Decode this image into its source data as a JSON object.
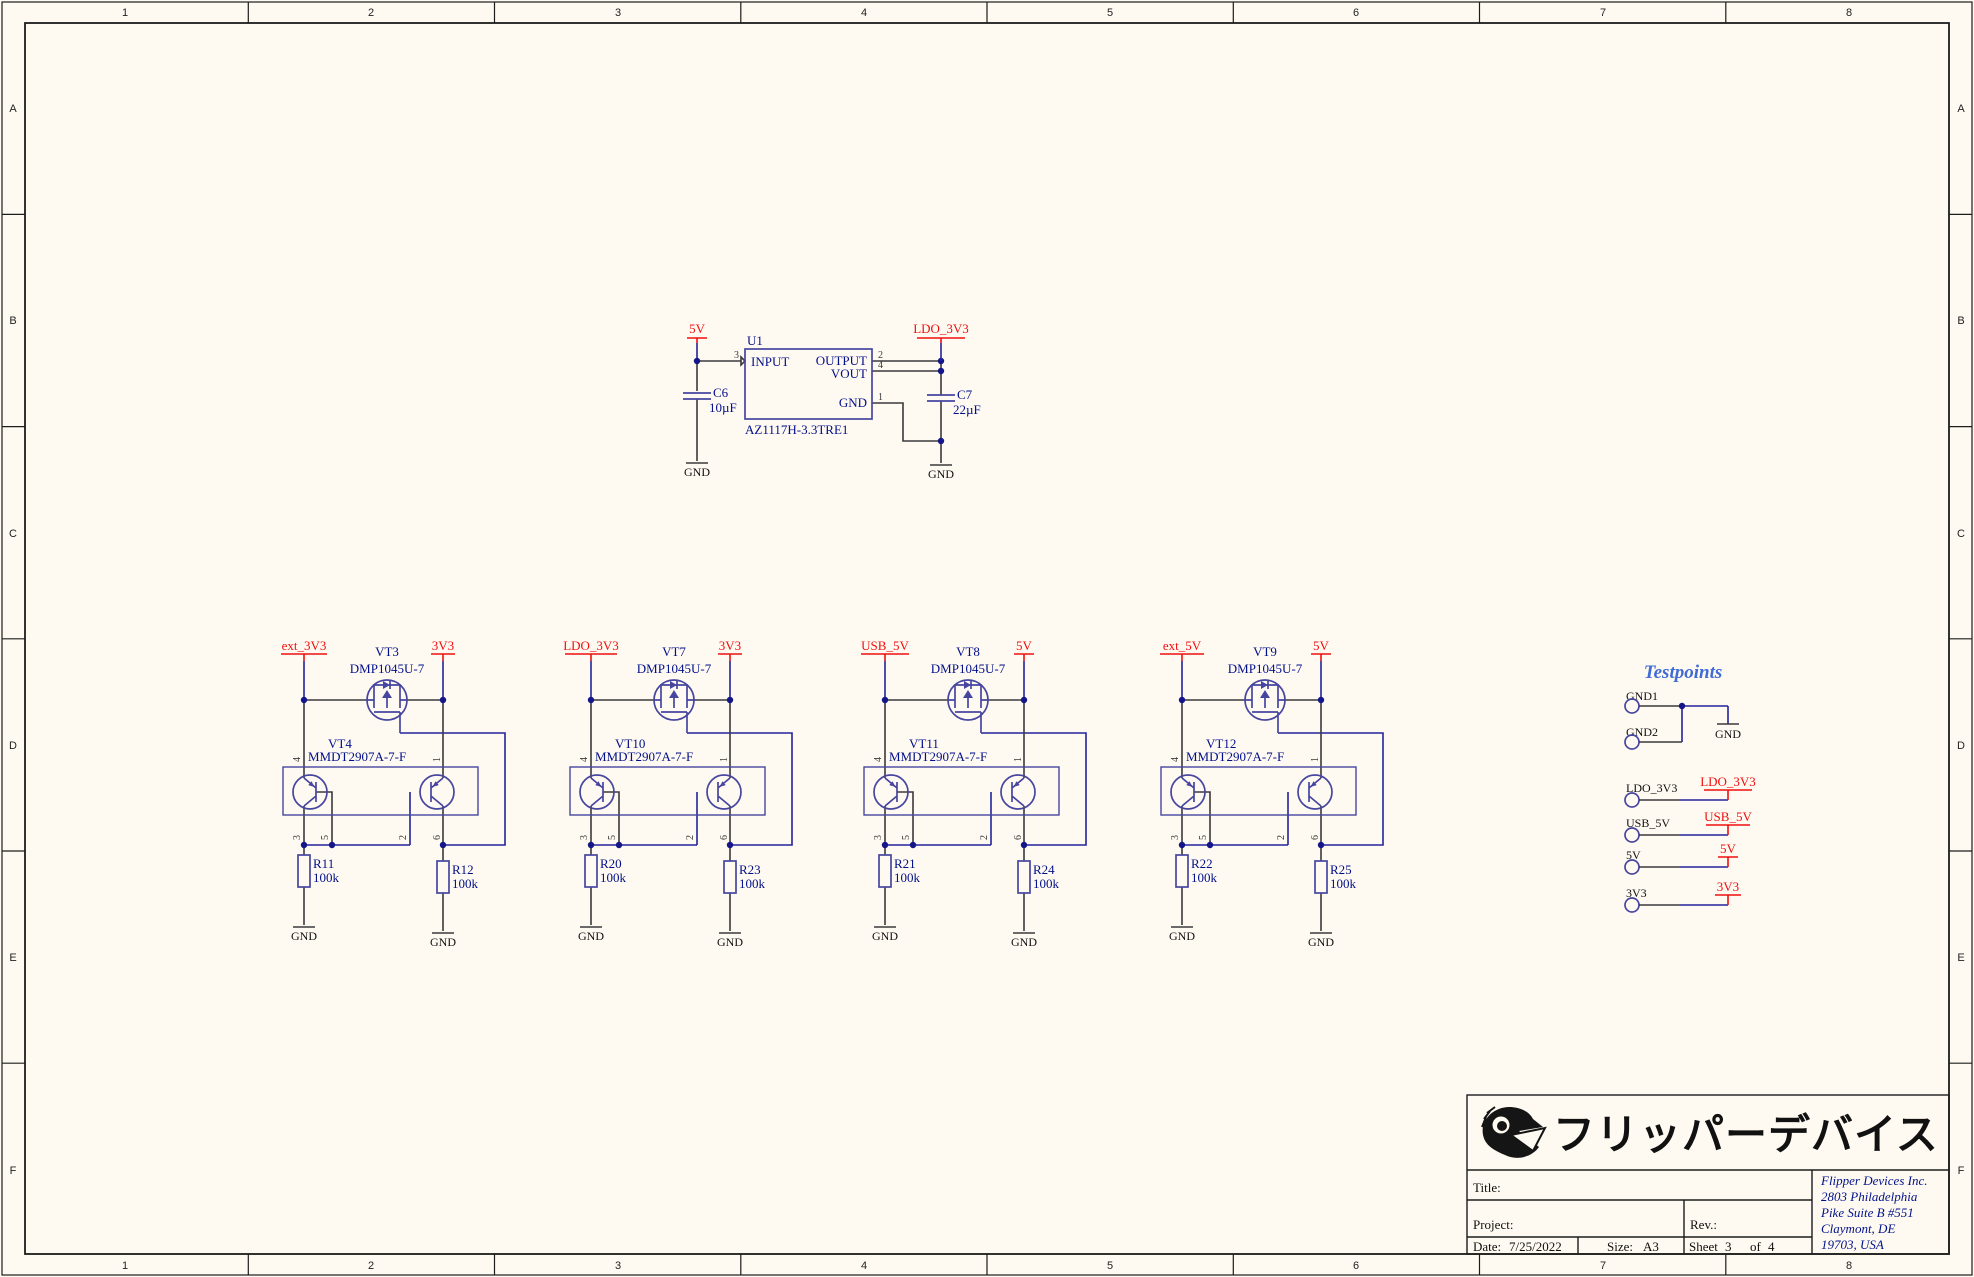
{
  "sheet": {
    "border": {
      "columns": [
        "1",
        "2",
        "3",
        "4",
        "5",
        "6",
        "7",
        "8"
      ],
      "rows": [
        "A",
        "B",
        "C",
        "D",
        "E",
        "F"
      ]
    }
  },
  "labels": {
    "gnd": "GND"
  },
  "regulator": {
    "ref": "U1",
    "part": "AZ1117H-3.3TRE1",
    "pin_input": "INPUT",
    "pin_output": "OUTPUT",
    "pin_vout": "VOUT",
    "pin_gnd": "GND",
    "num_input": "3",
    "num_output": "2",
    "num_vout": "4",
    "num_gnd": "1",
    "net_in": "5V",
    "net_out": "LDO_3V3",
    "cin_ref": "C6",
    "cin_val": "10µF",
    "cout_ref": "C7",
    "cout_val": "22µF"
  },
  "bjt_pins": {
    "e_left": "4",
    "e_right": "1",
    "c_left": "3",
    "b_left": "5",
    "b_right": "2",
    "c_right": "6"
  },
  "switch_groups": [
    {
      "left_net": "ext_3V3",
      "right_net": "3V3",
      "mosfet_ref": "VT3",
      "mosfet_part": "DMP1045U-7",
      "bjt_ref": "VT4",
      "bjt_part": "MMDT2907A-7-F",
      "r_left_ref": "R11",
      "r_left_val": "100k",
      "r_right_ref": "R12",
      "r_right_val": "100k"
    },
    {
      "left_net": "LDO_3V3",
      "right_net": "3V3",
      "mosfet_ref": "VT7",
      "mosfet_part": "DMP1045U-7",
      "bjt_ref": "VT10",
      "bjt_part": "MMDT2907A-7-F",
      "r_left_ref": "R20",
      "r_left_val": "100k",
      "r_right_ref": "R23",
      "r_right_val": "100k"
    },
    {
      "left_net": "USB_5V",
      "right_net": "5V",
      "mosfet_ref": "VT8",
      "mosfet_part": "DMP1045U-7",
      "bjt_ref": "VT11",
      "bjt_part": "MMDT2907A-7-F",
      "r_left_ref": "R21",
      "r_left_val": "100k",
      "r_right_ref": "R24",
      "r_right_val": "100k"
    },
    {
      "left_net": "ext_5V",
      "right_net": "5V",
      "mosfet_ref": "VT9",
      "mosfet_part": "DMP1045U-7",
      "bjt_ref": "VT12",
      "bjt_part": "MMDT2907A-7-F",
      "r_left_ref": "R22",
      "r_left_val": "100k",
      "r_right_ref": "R25",
      "r_right_val": "100k"
    }
  ],
  "testpoints": {
    "title": "Testpoints",
    "tp_gnd1": "GND1",
    "tp_gnd2": "GND2",
    "rows": [
      {
        "label": "LDO_3V3",
        "net": "LDO_3V3"
      },
      {
        "label": "USB_5V",
        "net": "USB_5V"
      },
      {
        "label": "5V",
        "net": "5V"
      },
      {
        "label": "3V3",
        "net": "3V3"
      }
    ]
  },
  "title_block": {
    "logo_text": "フリッパーデバイス",
    "title_label": "Title:",
    "project_label": "Project:",
    "rev_label": "Rev.:",
    "date_label": "Date:",
    "date": "7/25/2022",
    "size_label": "Size:",
    "size": "A3",
    "sheet_label": "Sheet",
    "sheet_num": "3",
    "of_label": "of",
    "sheet_total": "4",
    "address": [
      "Flipper Devices Inc.",
      "2803 Philadelphia",
      "Pike Suite B #551",
      "Claymont, DE",
      "19703, USA"
    ]
  }
}
